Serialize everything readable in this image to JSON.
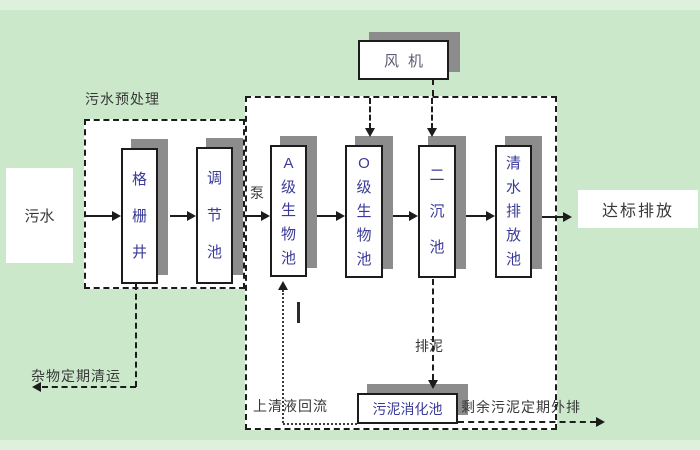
{
  "diagram": {
    "nodes": {
      "influent": "污水",
      "blower": "风机",
      "grid_well": "格栅井",
      "regulating_tank": "调节池",
      "tank_a": "A级生物池",
      "tank_o": "O级生物池",
      "secondary_clarifier": "二沉池",
      "clean_water_tank": "清水排放池",
      "sludge_digester": "污泥消化池",
      "effluent": "达标排放"
    },
    "labels": {
      "pretreatment": "污水预处理",
      "pump": "泵",
      "debris_removal": "杂物定期清运",
      "supernatant_return": "上清液回流",
      "sludge_discharge": "排泥",
      "excess_sludge_out": "剩余污泥定期外排"
    },
    "colors": {
      "background": "#cbe8cb",
      "box_fill": "#ffffff",
      "box_shadow": "#8c8c8c",
      "line": "#1c1c1c",
      "tank_text": "#3a3a9a",
      "label_text": "#383838",
      "blower_text": "#5c5c74"
    }
  }
}
